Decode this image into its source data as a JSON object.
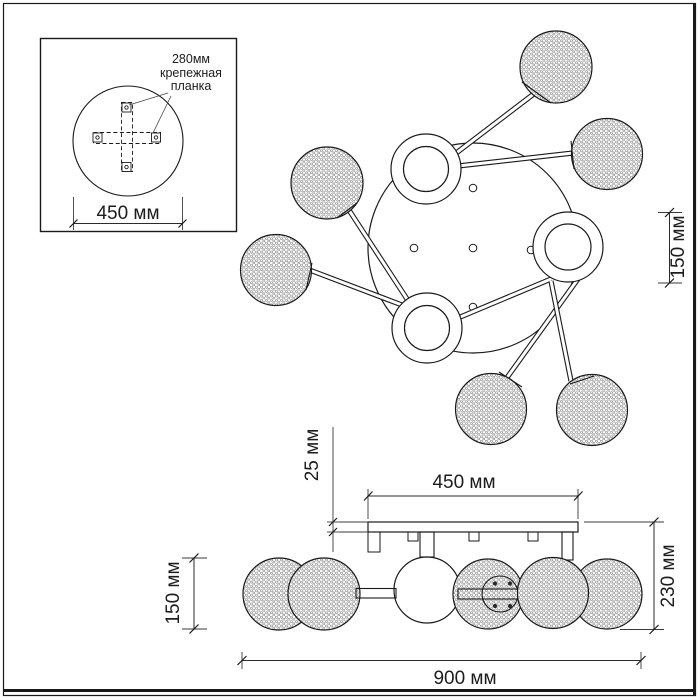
{
  "inset": {
    "callout": {
      "line1": "280мм",
      "line2": "крепежная",
      "line3": "планка"
    },
    "diameter_label": "450 мм"
  },
  "top_view": {
    "sphere_height_label": "150 мм"
  },
  "side_view": {
    "plate_thickness_label": "25 мм",
    "plate_length_label": "450 мм",
    "sphere_diameter_label": "150 мм",
    "total_height_label": "230 мм",
    "total_width_label": "900 мм"
  }
}
